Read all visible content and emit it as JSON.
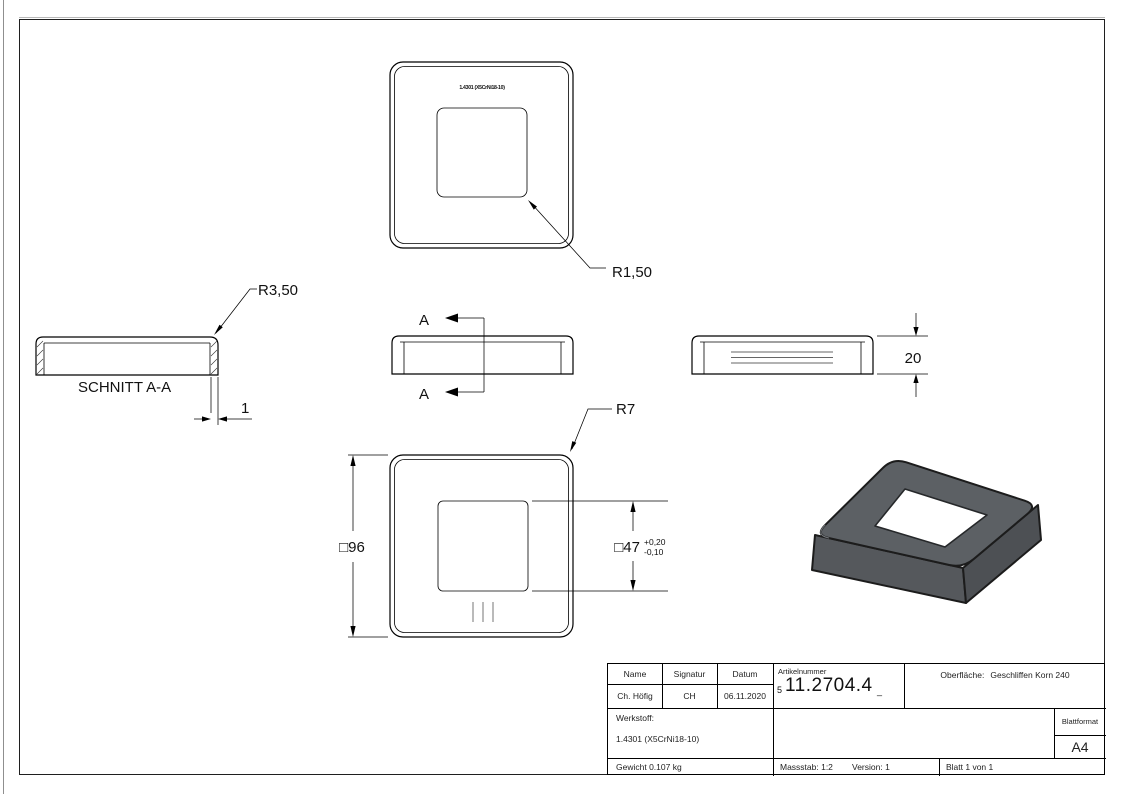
{
  "drawing": {
    "top_view": {
      "marking": "1.4301 (X5CrNi18-10)",
      "radius_label": "R1,50"
    },
    "section_view": {
      "title": "SCHNITT A-A",
      "radius_label": "R3,50",
      "thickness_dim": "1"
    },
    "side_view": {
      "cut_label": "A"
    },
    "right_view": {
      "height_dim": "20"
    },
    "front_view": {
      "outer_dim": "□96",
      "inner_dim": "□47",
      "tol_plus": "+0,20",
      "tol_minus": "-0,10",
      "radius_label": "R7"
    }
  },
  "title_block": {
    "headers": {
      "name": "Name",
      "signature": "Signatur",
      "date": "Datum"
    },
    "values": {
      "name": "Ch. Höfig",
      "signature": "CH",
      "date": "06.11.2020"
    },
    "article": {
      "label": "Artikelnummer",
      "prefix": "5",
      "number": "11.2704.4",
      "suffix": "_"
    },
    "surface": {
      "label": "Oberfläche:",
      "value": "Geschliffen Korn 240"
    },
    "material": {
      "label": "Werkstoff:",
      "value": "1.4301 (X5CrNi18-10)"
    },
    "weight": "Gewicht 0.107 kg",
    "scale": "Massstab: 1:2",
    "version": "Version: 1",
    "sheet": "Blatt 1 von 1",
    "format": {
      "label": "Blattformat",
      "value": "A4"
    }
  },
  "colors": {
    "part_top": "#5c6064",
    "part_left": "#55585c",
    "part_right": "#4d5054",
    "line": "#000000"
  }
}
